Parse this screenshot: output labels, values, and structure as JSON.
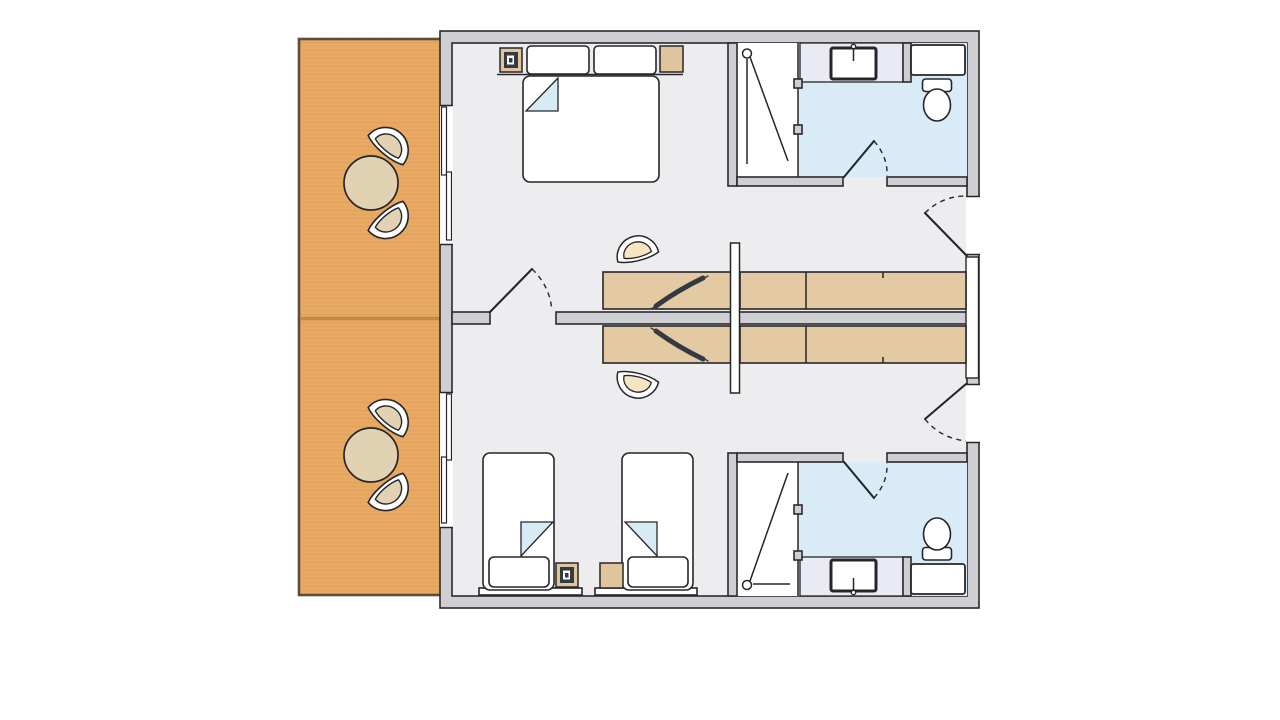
{
  "title": "Floor plan — two mirrored apartment units with terraces",
  "aria_label": "Architectural floor plan showing two mirrored apartment units. Each unit has a wooden terrace with a round table and two chairs, a bedroom (double bed in the upper unit, two single beds in the lower unit), a desk with a TV and chair, a built-in wardrobe, and a bathroom with shower, washbasin, toilet and cabinet.",
  "colors": {
    "background": "#ffffff",
    "terrace": "#e8a962",
    "terrace_border": "#5f4c38",
    "terrace_divider": "#c28a4a",
    "terrace_grain": "#c98c49",
    "wall_fill": "#cfcfd3",
    "wall_stroke": "#2a2a2e",
    "floor": "#ededef",
    "bathroom_floor": "#d9ebf7",
    "vanity_counter": "#eaeaf5",
    "wood": "#e3caa2",
    "wood_dark": "#dfc49e",
    "seat_cream": "#f5e5c1",
    "terrace_seat": "#e2d2b4",
    "fold_blue": "#d6ebf4",
    "tv": "#343a42",
    "line": "#26262a"
  },
  "terraces": [
    {
      "name": "upper terrace",
      "furniture": [
        "round table",
        "two curved chairs"
      ]
    },
    {
      "name": "lower terrace",
      "furniture": [
        "round table",
        "two curved chairs"
      ]
    }
  ],
  "units": [
    {
      "name": "upper unit",
      "bedroom": [
        "double bed",
        "two pillows",
        "bedside cabinet with lamp",
        "bedside cabinet",
        "desk with tv",
        "desk chair",
        "wardrobe"
      ],
      "bathroom": [
        "shower",
        "washbasin",
        "toilet",
        "wall cabinet"
      ],
      "doors": [
        "terrace sliding door",
        "connecting door",
        "bathroom door",
        "entrance door"
      ]
    },
    {
      "name": "lower unit",
      "bedroom": [
        "single bed",
        "single bed",
        "bedside cabinet with lamp",
        "bedside cabinet",
        "desk with tv",
        "desk chair",
        "wardrobe"
      ],
      "bathroom": [
        "shower",
        "washbasin",
        "toilet",
        "wall cabinet"
      ],
      "doors": [
        "terrace sliding door",
        "bathroom door",
        "entrance door"
      ]
    }
  ]
}
